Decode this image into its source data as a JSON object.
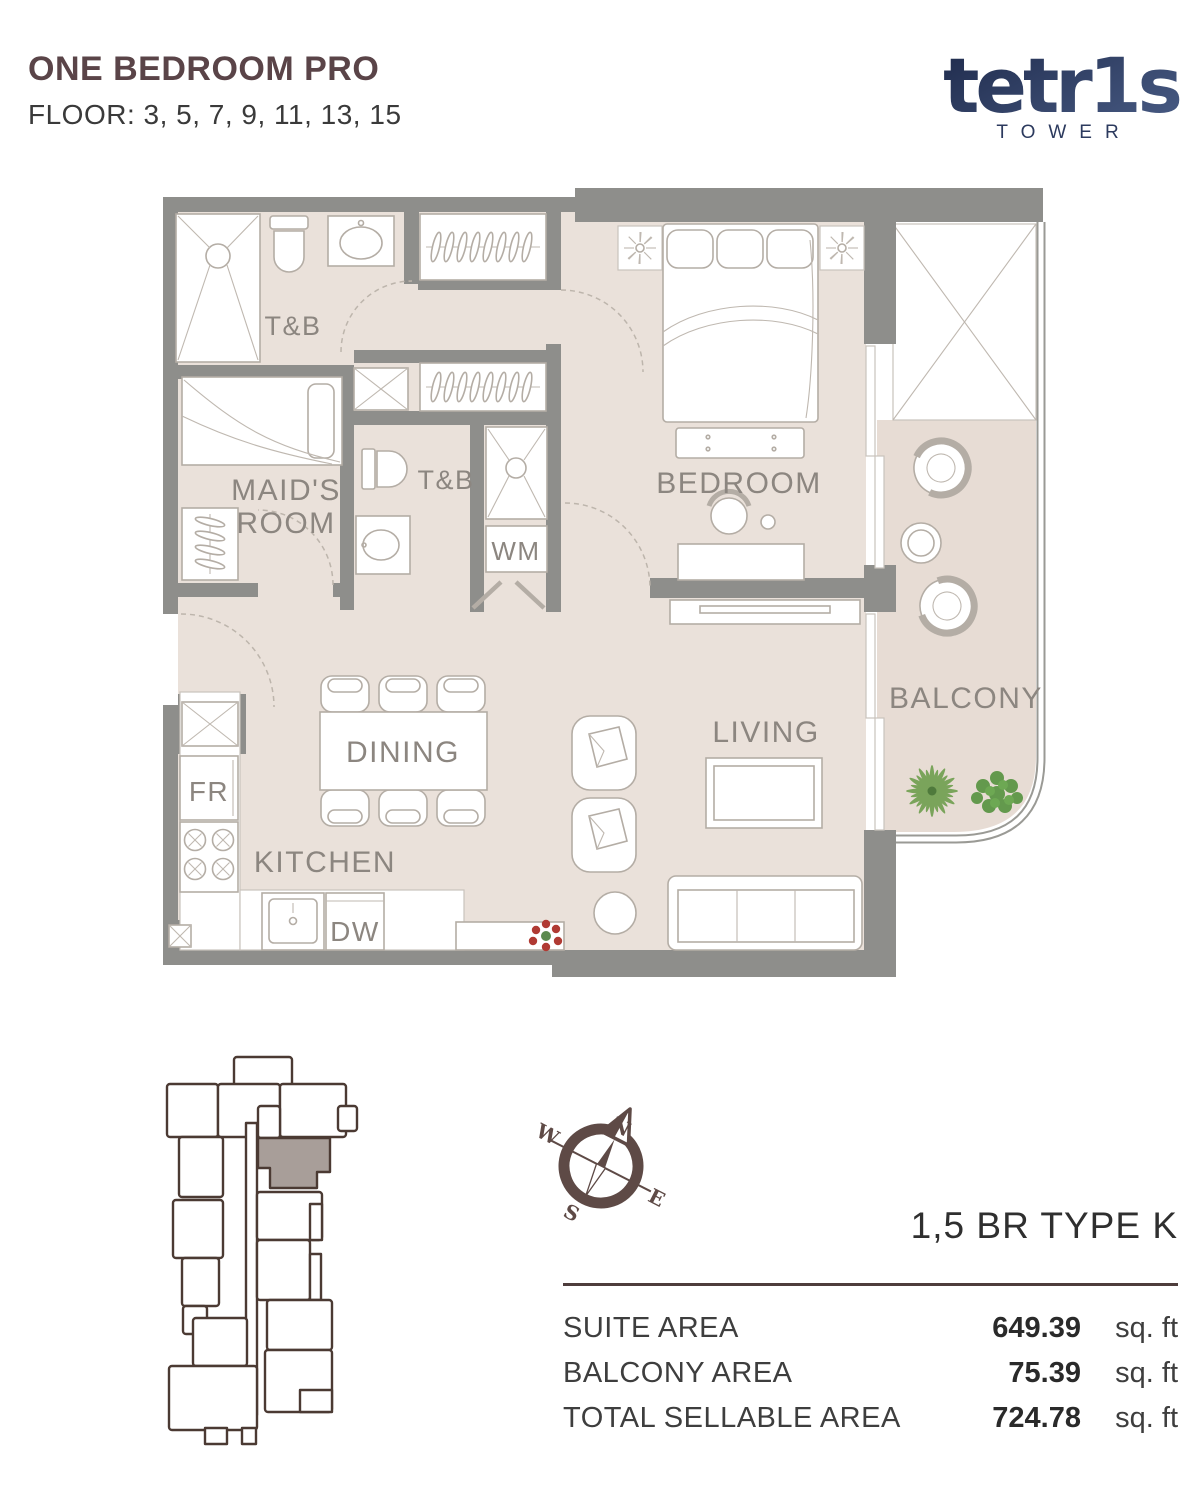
{
  "header": {
    "title": "ONE BEDROOM PRO",
    "floor_line": "FLOOR: 3, 5, 7, 9, 11, 13, 15"
  },
  "logo": {
    "brand": "tetr1s",
    "subtitle": "TOWER"
  },
  "plan": {
    "labels": {
      "tb_top": "T&B",
      "maids_line1": "MAID'S",
      "maids_line2": "ROOM",
      "tb_mid": "T&B",
      "wm": "WM",
      "bedroom": "BEDROOM",
      "balcony": "BALCONY",
      "dining": "DINING",
      "kitchen": "KITCHEN",
      "living": "LIVING",
      "fridge": "FR",
      "dishwasher": "DW"
    }
  },
  "compass": {
    "north": "N",
    "east": "E",
    "south": "S",
    "west": "W"
  },
  "unit_summary": {
    "type_label": "1,5 BR TYPE K",
    "rows": [
      {
        "label": "SUITE AREA",
        "value": "649.39",
        "unit": "sq. ft"
      },
      {
        "label": "BALCONY AREA",
        "value": "75.39",
        "unit": "sq. ft"
      },
      {
        "label": "TOTAL SELLABLE AREA",
        "value": "724.78",
        "unit": "sq. ft"
      }
    ]
  },
  "colors": {
    "title": "#5a4448",
    "logo_navy": "#2c3a5e",
    "wall": "#8e8e8b",
    "floor": "#eae1da",
    "balcony_floor": "#e7dcd4",
    "furniture_line": "#b4ada5",
    "label_text": "#8c8680",
    "keyplan_outline": "#4b3a33",
    "keyplan_highlight": "#a89e99",
    "compass": "#5e4a46",
    "rule": "#4e3d3c",
    "plant_green": "#6fa05a",
    "flower_red": "#b03a33"
  }
}
